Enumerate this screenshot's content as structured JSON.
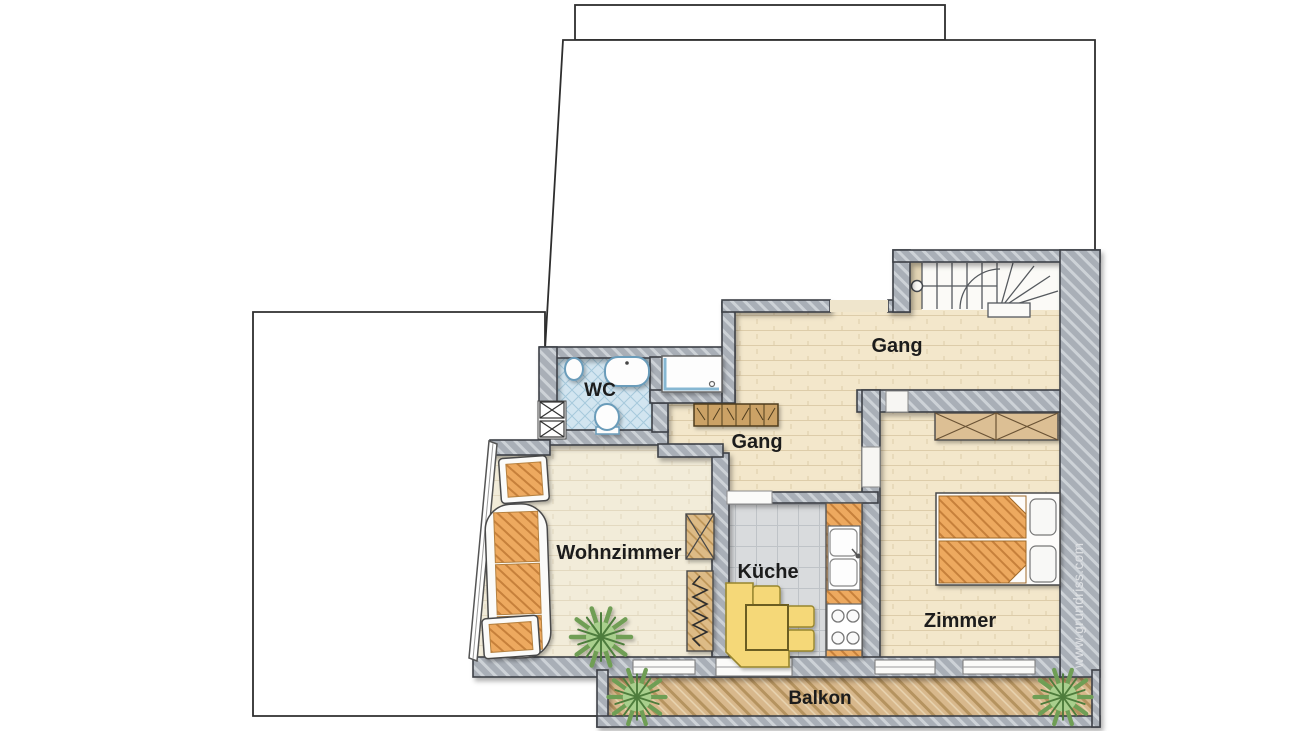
{
  "rooms": {
    "wc": {
      "label": "WC"
    },
    "gang_upper": {
      "label": "Gang"
    },
    "gang_lower": {
      "label": "Gang"
    },
    "wohnzimmer": {
      "label": "Wohnzimmer"
    },
    "kueche": {
      "label": "Küche"
    },
    "zimmer": {
      "label": "Zimmer"
    },
    "balkon": {
      "label": "Balkon"
    }
  },
  "watermark": {
    "text": "www.grundriss.com"
  },
  "palette": {
    "wall_gray": "#a9afb7",
    "outline_dark": "#3c4046",
    "floor_beige": "#f3e7cb",
    "floor_pale": "#f2ecd9",
    "wc_tile_blue": "#d2e5f0",
    "kitchen_tile_gray": "#d9dbdd",
    "balcony_wood": "#d8b88c",
    "furniture_orange": "#eda95e",
    "wardrobe_tan": "#dcbf94",
    "dining_yellow": "#f5d878",
    "plant_green": "#a9cf8d",
    "fixture_blue": "#6b9cba"
  },
  "furniture_icons": [
    "staircase",
    "wardrobe",
    "double-bed",
    "pillow",
    "sofa",
    "armchair",
    "side-chair",
    "plant",
    "side-table",
    "radiator-shelf",
    "kitchen-counter",
    "double-sink",
    "stove",
    "corner-bench",
    "dining-table",
    "dining-chair",
    "wash-basin",
    "urinal",
    "toilet",
    "shower",
    "door-frame",
    "window"
  ]
}
